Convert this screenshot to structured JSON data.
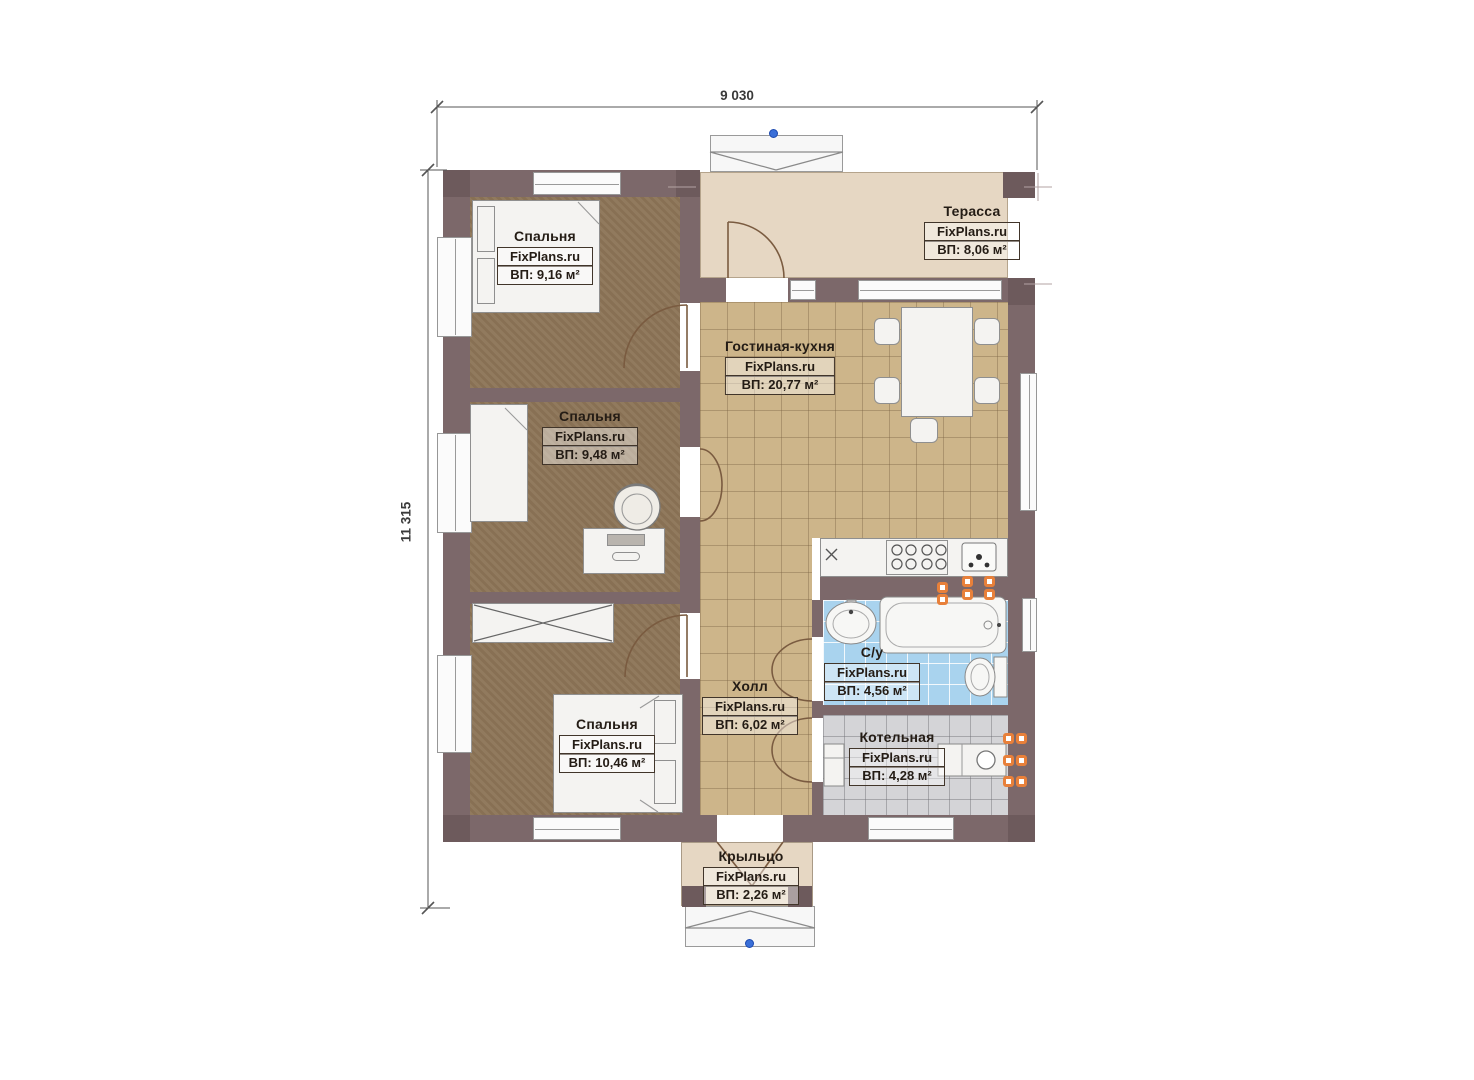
{
  "title": "Floor plan",
  "brand": "FixPlans.ru",
  "dimensions": {
    "width": "9 030",
    "height": "11 315"
  },
  "rooms": [
    {
      "key": "bedroom-1",
      "name": "Спальня",
      "watermark": "FixPlans.ru",
      "area": "ВП: 9,16 м²"
    },
    {
      "key": "terrace",
      "name": "Терасса",
      "watermark": "FixPlans.ru",
      "area": "ВП: 8,06 м²"
    },
    {
      "key": "living-kitchen",
      "name": "Гостиная-кухня",
      "watermark": "FixPlans.ru",
      "area": "ВП: 20,77 м²"
    },
    {
      "key": "bedroom-2",
      "name": "Спальня",
      "watermark": "FixPlans.ru",
      "area": "ВП: 9,48 м²"
    },
    {
      "key": "bathroom",
      "name": "С/у",
      "watermark": "FixPlans.ru",
      "area": "ВП: 4,56 м²"
    },
    {
      "key": "hall",
      "name": "Холл",
      "watermark": "FixPlans.ru",
      "area": "ВП: 6,02 м²"
    },
    {
      "key": "bedroom-3",
      "name": "Спальня",
      "watermark": "FixPlans.ru",
      "area": "ВП: 10,46 м²"
    },
    {
      "key": "boiler-room",
      "name": "Котельная",
      "watermark": "FixPlans.ru",
      "area": "ВП: 4,28 м²"
    },
    {
      "key": "porch",
      "name": "Крыльцо",
      "watermark": "FixPlans.ru",
      "area": "ВП: 2,26 м²"
    }
  ],
  "colors": {
    "wall": "#7c686a",
    "wall_dark": "#6d5a5c",
    "bedroom_floor": "#8d7557",
    "tile_floor": "#cdb58a",
    "terrace_floor": "#e6d7c3",
    "bath_tile": "#a9d3ee",
    "boiler_tile": "#d4d4d7",
    "pipe_orange": "#e8803a",
    "marker_blue": "#3a6fd8",
    "label_ink": "#241c15"
  }
}
